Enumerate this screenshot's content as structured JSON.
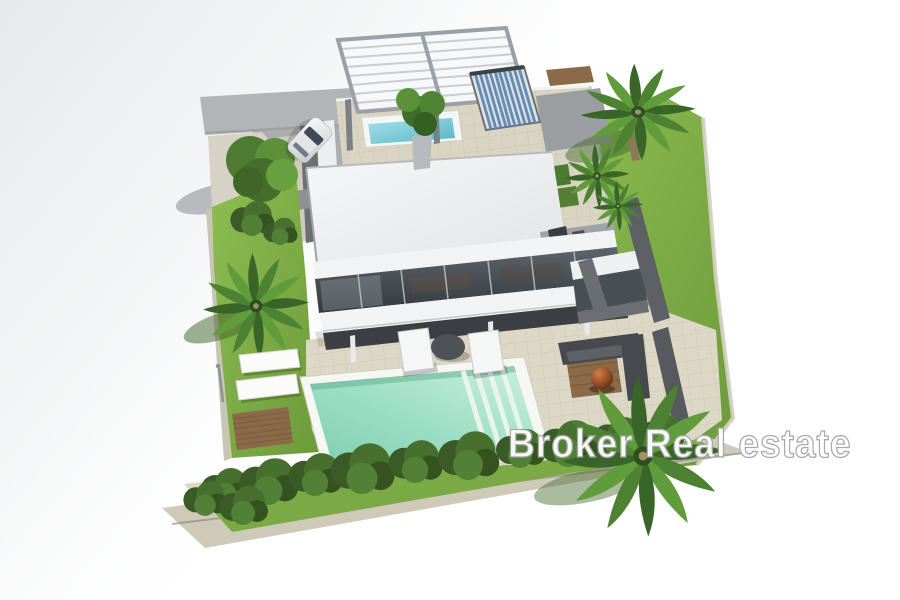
{
  "image": {
    "kind": "3d-architectural-render",
    "description": "Aerial 3D rendering of a modern two-storey villa with rooftop terrace, swimming pool and landscaped garden",
    "watermark": "Broker Real estate"
  },
  "scene": {
    "features": [
      "driveway-road",
      "white-car",
      "garden-tree",
      "entrance-path",
      "left-garden-lawn",
      "palm-trees",
      "sun-loungers",
      "wooden-deck",
      "outdoor-shower",
      "pergola",
      "jacuzzi",
      "potted-plant",
      "solar-panel",
      "rooftop-terrace",
      "rooftop-bench",
      "flat-white-roof",
      "roof-vents",
      "glass-facade",
      "ground-floor-terrace",
      "patio-furniture",
      "pool-terrace",
      "swimming-pool",
      "pool-steps",
      "garden-hedge",
      "retaining-walls",
      "outdoor-lounge-sofa",
      "fire-bowl",
      "right-garden-lawn"
    ],
    "pool": {
      "shape": "rectangular",
      "steps_location": "right end"
    }
  },
  "colors": {
    "background": "#ffffff",
    "haze": "#e7e9eb",
    "road": "#b2b4b6",
    "lawn_light": "#8ab94f",
    "lawn_dark": "#6f9e3c",
    "stone": "#ddd8c6",
    "stone_dark": "#cfcab8",
    "roof_white": "#f3f4f5",
    "facade_white": "#f2f3f4",
    "glass_dark": "#484f55",
    "wall_dark": "#6b6f73",
    "pool_rim": "#f6f6f3",
    "pool_water": "#9fdfc6",
    "jacuzzi_water": "#7fd0dc",
    "solar_blue": "#5b84ae",
    "pergola_frame": "#9aa0a5",
    "palm_green": "#4d8233",
    "bush_green": "#3f6129",
    "wood_brown": "#8a6a48",
    "sofa_gray": "#46494d",
    "fire_copper": "#a4552a",
    "watermark_fill": "#ffffff",
    "watermark_outline": "#a4a6a8"
  }
}
